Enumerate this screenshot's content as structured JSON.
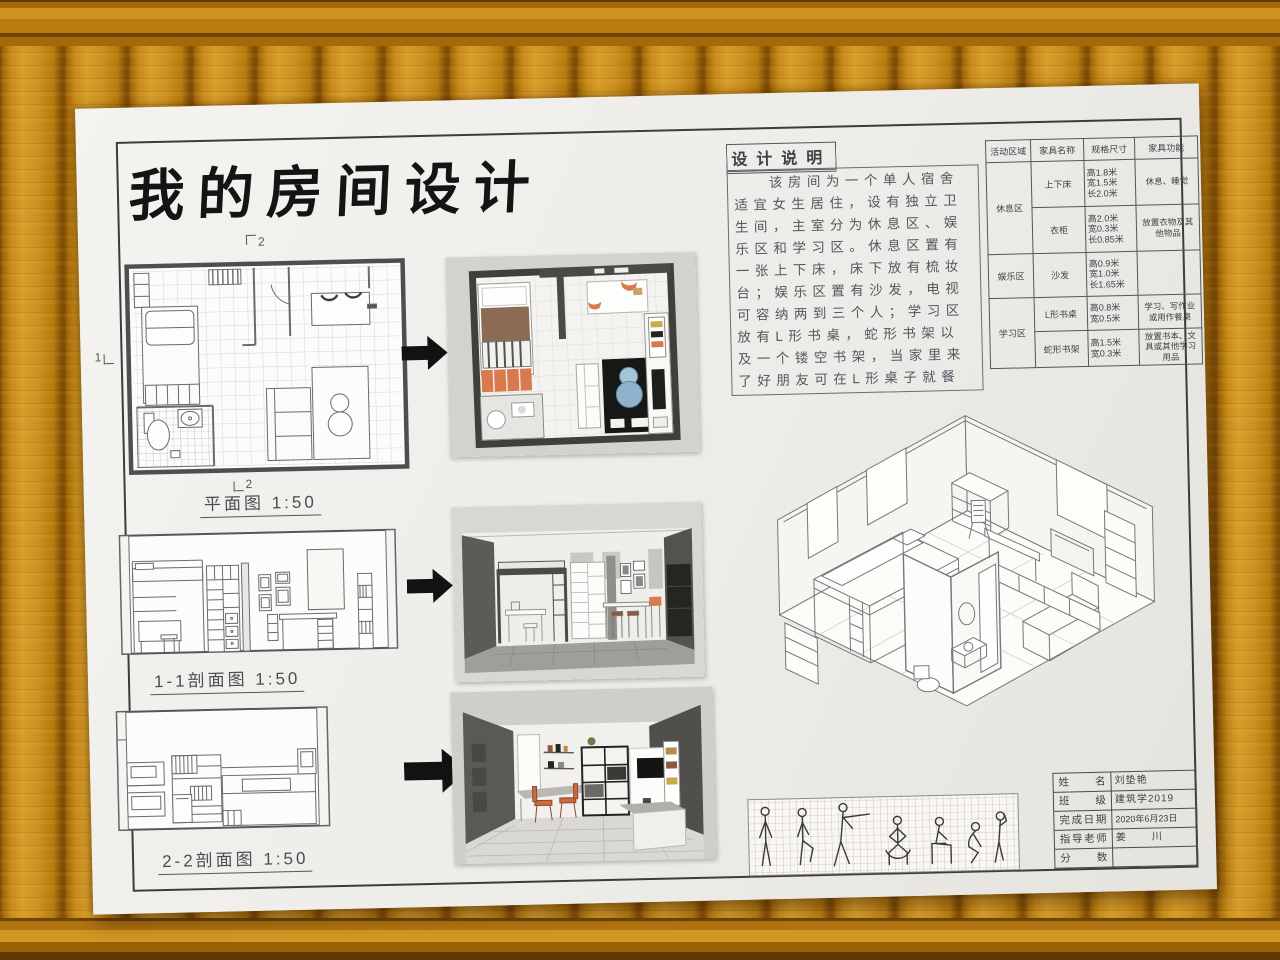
{
  "poster": {
    "title": "我的房间设计",
    "design_notes": {
      "heading": "设计说明",
      "lines": [
        "该房间为一个单人宿舍",
        "适宜女生居住，设有独立卫",
        "生间，主室分为休息区、娱",
        "乐区和学习区。休息区置有",
        "一张上下床，床下放有梳妆",
        "台；娱乐区置有沙发，电视",
        "可容纳两到三个人；学习区",
        "放有L形书桌，蛇形书架以",
        "及一个镂空书架，当家里来",
        "了好朋友可在L形桌子就餐"
      ]
    },
    "drawings": {
      "plan_label": "平面图 1:50",
      "section1_label": "1-1剖面图 1:50",
      "section2_label": "2-2剖面图 1:50",
      "marker_section1": "1",
      "marker_section2": "2"
    },
    "furniture_table": {
      "headers": [
        "活动区域",
        "家具名称",
        "规格尺寸",
        "家具功能"
      ],
      "rows": [
        {
          "zone": "休息区",
          "name": "上下床",
          "spec": [
            "高1.8米",
            "宽1.5米",
            "长2.0米"
          ],
          "function": "休息、睡觉"
        },
        {
          "name": "衣柜",
          "spec": [
            "高2.0米",
            "宽0.3米",
            "长0.85米"
          ],
          "function": "放置衣物及其他物品"
        },
        {
          "zone": "娱乐区",
          "name": "沙发",
          "spec": [
            "高0.9米",
            "宽1.0米",
            "长1.65米"
          ],
          "function": ""
        },
        {
          "zone": "学习区",
          "name": "L形书桌",
          "spec": [
            "高0.8米",
            "宽0.5米"
          ],
          "function": "学习、写作业或用作餐桌"
        },
        {
          "name": "蛇形书架",
          "spec": [
            "高1.5米",
            "宽0.3米"
          ],
          "function": "放置书本、文具或其他学习用品"
        }
      ]
    },
    "title_block": {
      "rows": [
        {
          "label": "姓名",
          "value": "刘垫艳"
        },
        {
          "label": "班级",
          "value": "建筑学2019"
        },
        {
          "label": "完成日期",
          "value": "2020年6月23日"
        },
        {
          "label": "指导老师",
          "value": "姜　川"
        },
        {
          "label": "分数",
          "value": ""
        }
      ]
    },
    "colors": {
      "bamboo": "#c68a18",
      "paper": "#f0efeb",
      "pencil": "#6a6a70",
      "ink": "#141414",
      "accent_orange": "#d97a4e",
      "accent_blue": "#8fb3cc",
      "render_wall_dark": "#4a4946",
      "rug_black": "#171715"
    }
  }
}
